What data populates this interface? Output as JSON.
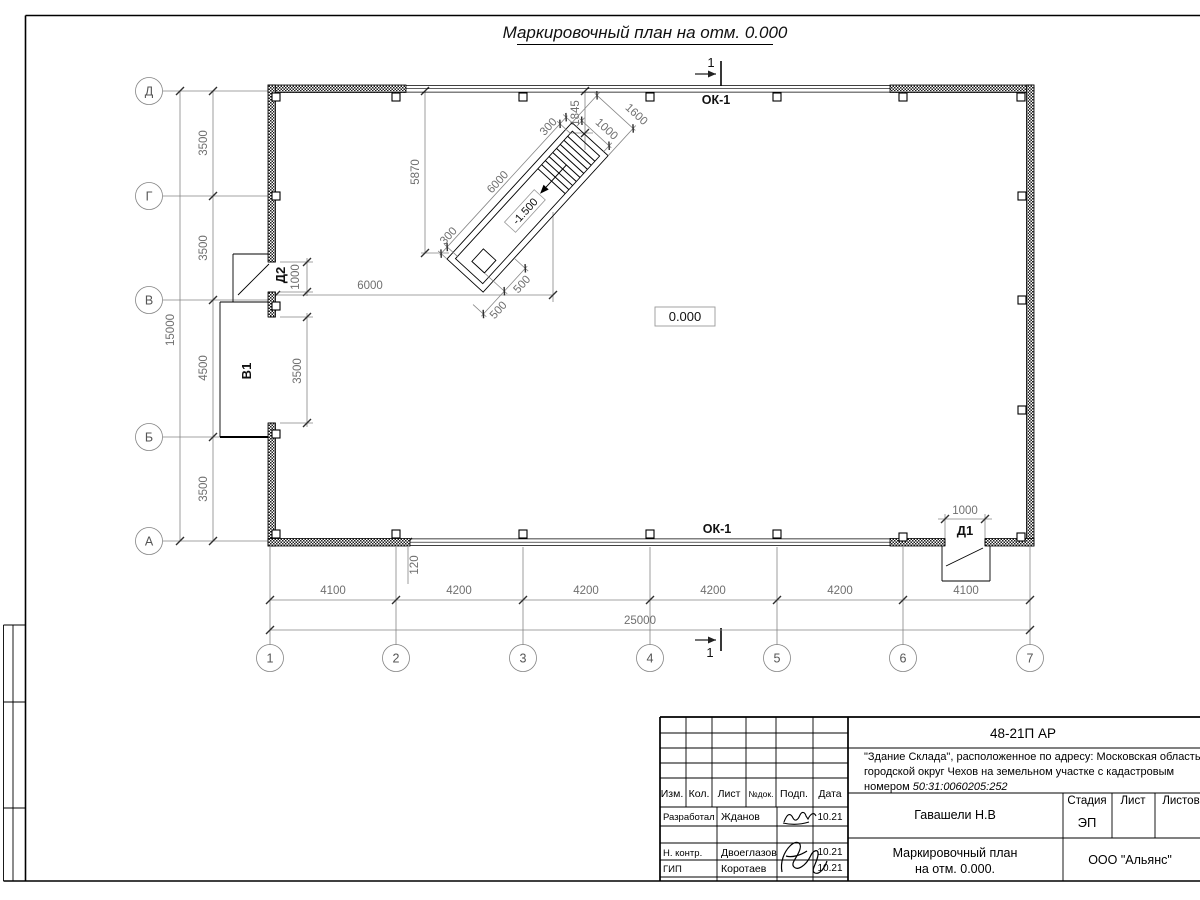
{
  "title": "Маркировочный план на отм. 0.000",
  "section_mark": "1",
  "axes": {
    "horizontal": [
      "Д",
      "Г",
      "В",
      "Б",
      "А"
    ],
    "vertical": [
      "1",
      "2",
      "3",
      "4",
      "5",
      "6",
      "7"
    ]
  },
  "dims": {
    "left": {
      "d_g": "3500",
      "g_v": "3500",
      "v_b": "4500",
      "b_a": "3500",
      "total": "15000"
    },
    "bottom": {
      "s1": "4100",
      "s2": "4200",
      "s3": "4200",
      "s4": "4200",
      "s5": "4200",
      "s6": "4100",
      "total": "25000"
    },
    "plan": {
      "to_ramp": "6000",
      "wall_offset": "120",
      "d2_width": "1000",
      "v1_width": "3500",
      "d1_width": "1000",
      "ramp_to_wall": "5870",
      "stair_exit": "1845",
      "ramp_len": "6000",
      "margin_end": "300",
      "margin_start": "300",
      "stair_width": "1000",
      "ramp_width": "1600",
      "plat_a": "500",
      "plat_b": "500"
    }
  },
  "levels": {
    "zero": "0.000",
    "pit": "-1.500"
  },
  "marks": {
    "window": "ОК-1",
    "door1": "Д1",
    "door2": "Д2",
    "gate": "В1"
  },
  "titleblock": {
    "doc_number": "48-21П АР",
    "project_line1": "\"Здание Склада\", расположенное по адресу: Московская область,",
    "project_line2": "городской округ Чехов на земельном участке с кадастровым",
    "project_line3_prefix": "номером ",
    "project_line3_cadastre": "50:31:0060205:252",
    "header": {
      "izm": "Изм.",
      "kol": "Кол.",
      "list": "Лист",
      "ndoc": "№док.",
      "podp": "Подп.",
      "data": "Дата"
    },
    "rows": [
      {
        "role": "Разработал",
        "name": "Жданов",
        "date": "10.21"
      },
      {
        "role": "Н. контр.",
        "name": "Двоеглазов",
        "date": "10.21"
      },
      {
        "role": "ГИП",
        "name": "Коротаев",
        "date": "10.21"
      }
    ],
    "chief": "Гавашели Н.В",
    "stage_label": "Стадия",
    "sheet_label": "Лист",
    "sheets_label": "Листов",
    "stage_value": "ЭП",
    "sheet_title_line1": "Маркировочный план",
    "sheet_title_line2": "на отм. 0.000.",
    "company": "ООО \"Альянс\""
  }
}
